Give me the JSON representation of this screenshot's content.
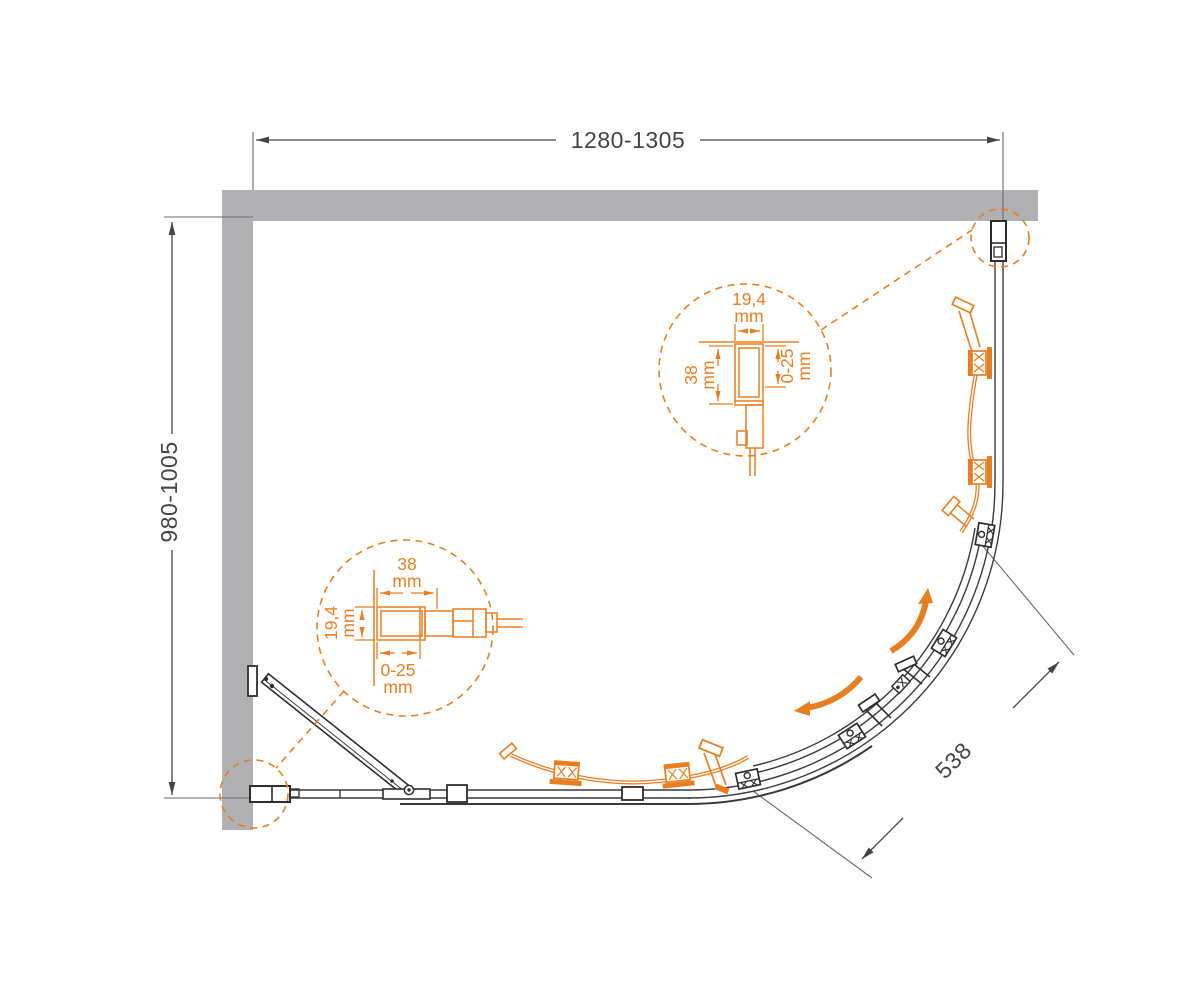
{
  "diagram": {
    "type": "shower-enclosure-plan-drawing",
    "dims": {
      "width": "1280-1305",
      "depth": "980-1005",
      "radius": "538"
    },
    "detail_top": {
      "width": "19,4",
      "width_unit": "mm",
      "depth": "38",
      "depth_unit": "mm",
      "adjust": "0-25",
      "adjust_unit": "mm"
    },
    "detail_bottom": {
      "width": "38",
      "width_unit": "mm",
      "depth": "19,4",
      "depth_unit": "mm",
      "adjust": "0-25",
      "adjust_unit": "mm"
    },
    "colors": {
      "accent_orange": "#e87e22",
      "wall_gray": "#b1b1b3",
      "line_dark": "#3a3a3d",
      "text_dark": "#454547"
    }
  }
}
